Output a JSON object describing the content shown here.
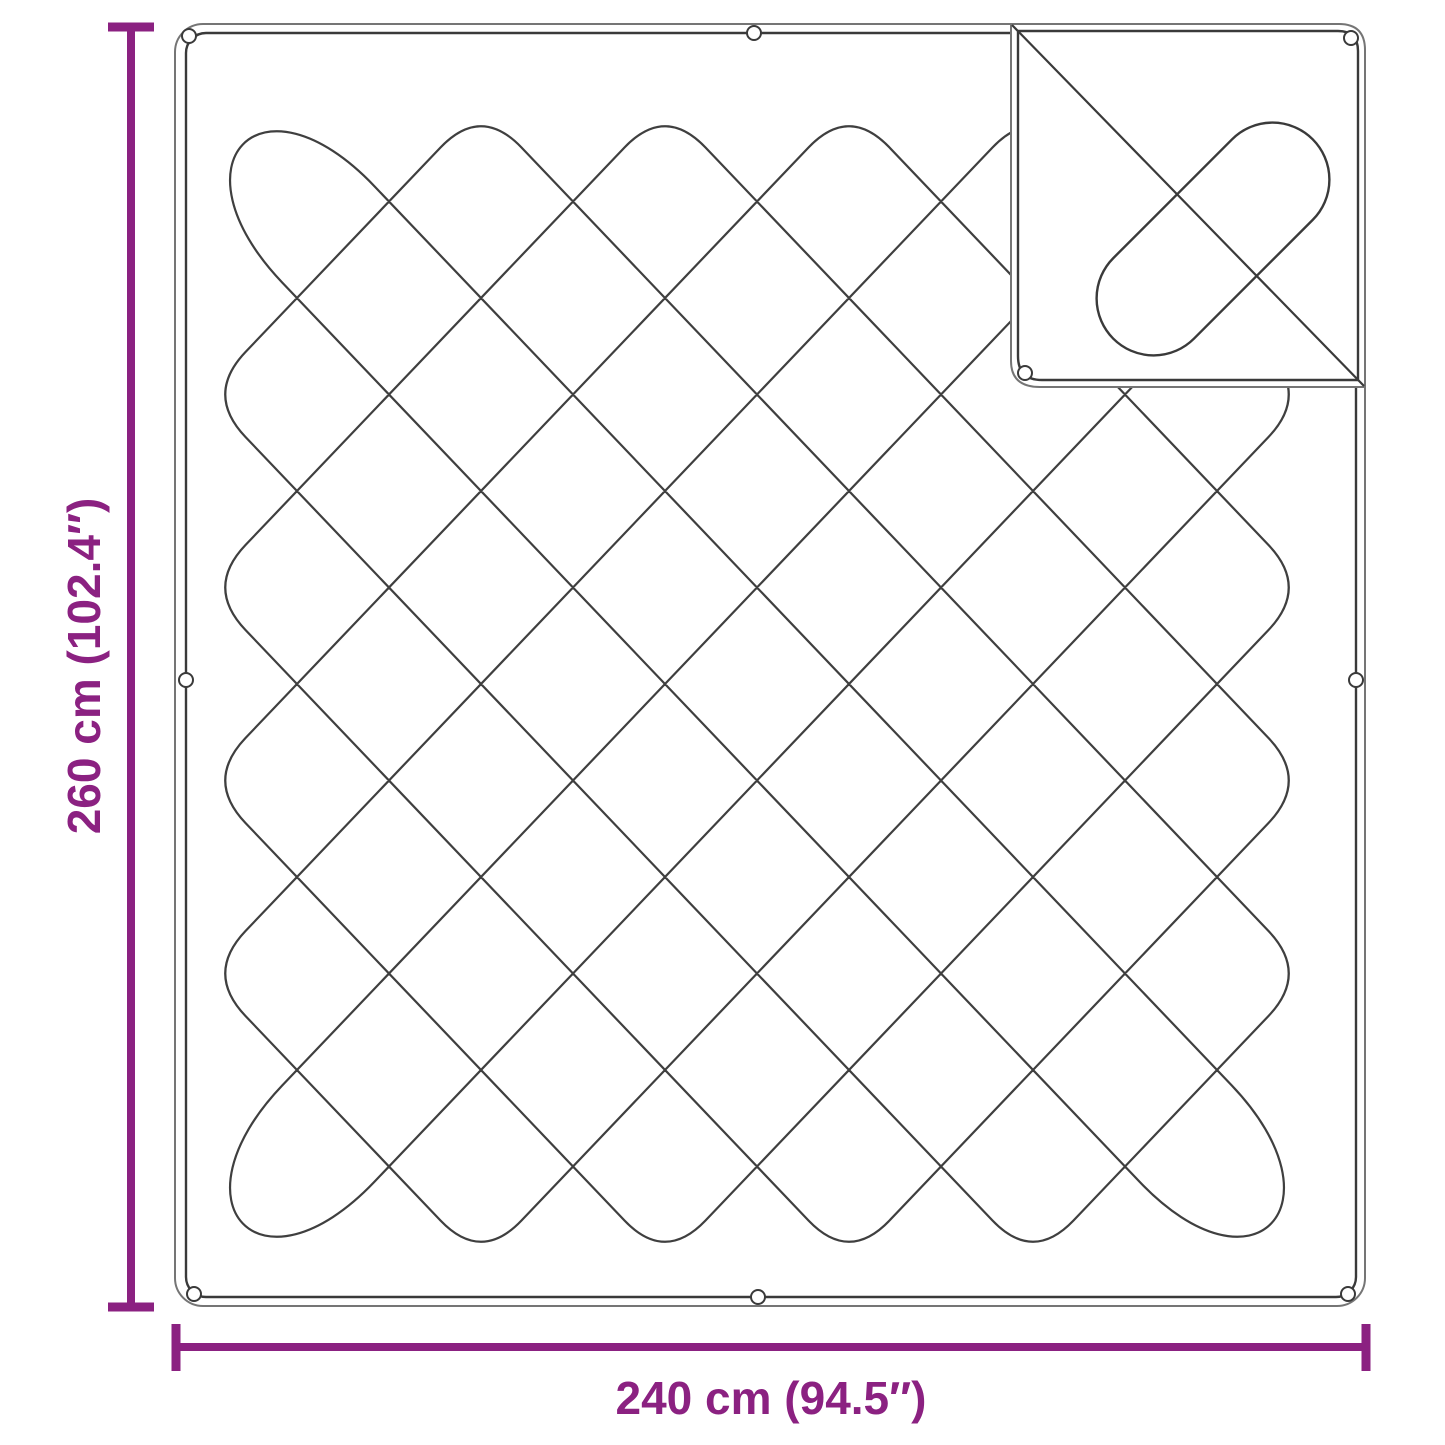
{
  "diagram": {
    "type": "product-dimension-diagram",
    "subject": "quilted blanket with folded corner flap",
    "vertical_dimension": {
      "label": "260 cm (102.4″)"
    },
    "horizontal_dimension": {
      "label": "240 cm (94.5″)"
    },
    "colors": {
      "dimension": "#8b2181",
      "line_dark": "#3a3a3a",
      "line_light": "#757575",
      "background": "#ffffff"
    }
  }
}
